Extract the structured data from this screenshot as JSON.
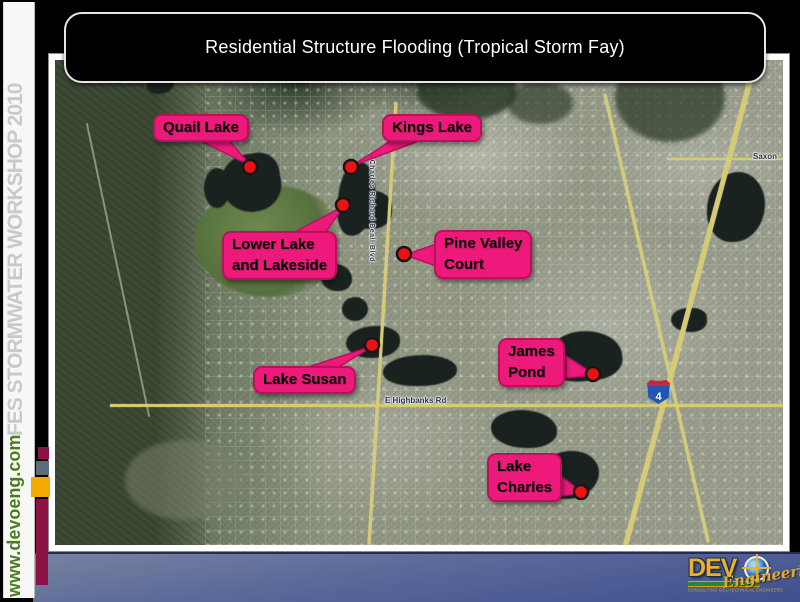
{
  "slide": {
    "title": "Residential Structure Flooding (Tropical Storm Fay)"
  },
  "sidebar": {
    "workshop_label": "FES STORMWATER WORKSHOP 2010",
    "website_label": "www.devoeng.com"
  },
  "map": {
    "callouts": [
      {
        "name": "quail-lake",
        "line1": "Quail Lake",
        "line2": ""
      },
      {
        "name": "kings-lake",
        "line1": "Kings Lake",
        "line2": ""
      },
      {
        "name": "lower-lake-lakeside",
        "line1": "Lower Lake",
        "line2": "and Lakeside"
      },
      {
        "name": "pine-valley-court",
        "line1": "Pine Valley",
        "line2": "Court"
      },
      {
        "name": "lake-susan",
        "line1": "Lake Susan",
        "line2": ""
      },
      {
        "name": "james-pond",
        "line1": "James",
        "line2": "Pond"
      },
      {
        "name": "lake-charles",
        "line1": "Lake",
        "line2": "Charles"
      }
    ],
    "road_labels": {
      "highbanks": "E Highbanks Rd",
      "saxon": "Saxon",
      "beall_blvd": "S Charles Richard Beall Blvd"
    },
    "interstate_shield_number": "4"
  },
  "logo": {
    "wordmark": "DEV",
    "script_word": "Engineering",
    "tagline": "CONSULTING GEOTECHNICAL ENGINEERS"
  },
  "colors": {
    "callout_pink": "#ee1a7b",
    "callout_border": "#b8125d",
    "marker_red": "#ee1111",
    "sidebar_gray_text": "#c9c9c9",
    "website_green": "#4a7c20",
    "stripe_maroon": "#8e1345",
    "stripe_slate": "#5c6b7d",
    "stripe_amber": "#f5a800",
    "bottom_bar_blue": "#56689a",
    "logo_gold": "#e8b22c"
  }
}
